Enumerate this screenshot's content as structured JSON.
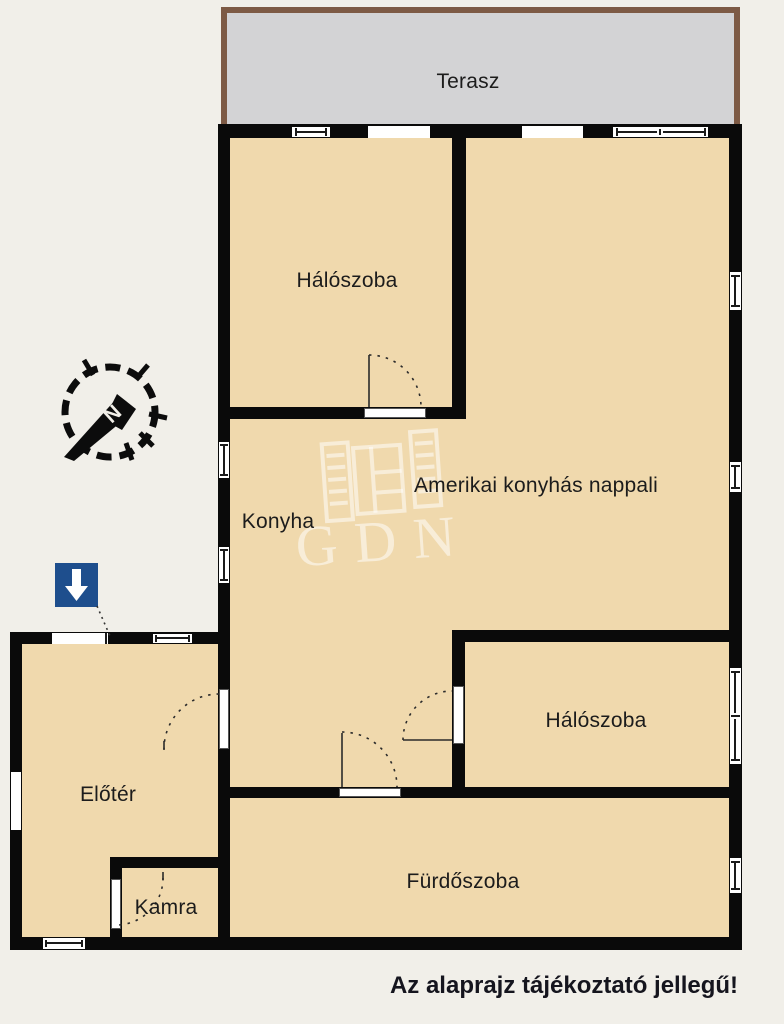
{
  "colors": {
    "bg": "#f1efe9",
    "floor": "#f0d9ad",
    "wall": "#0a0a0a",
    "terrace-fill": "#d3d3d5",
    "terrace-border": "#7d5a45",
    "arrow-blue": "#1e4e8d",
    "label": "#1c1c1c",
    "disclaimer": "#15151e",
    "watermark": "rgba(255,255,255,0.52)"
  },
  "rooms": {
    "terrace": {
      "label": "Terasz"
    },
    "bedroom_top": {
      "label": "Hálószoba"
    },
    "living": {
      "label": "Amerikai konyhás nappali"
    },
    "kitchen": {
      "label": "Konyha"
    },
    "bedroom_right": {
      "label": "Hálószoba"
    },
    "foyer": {
      "label": "Előtér"
    },
    "pantry": {
      "label": "Kamra"
    },
    "bathroom": {
      "label": "Fürdőszoba"
    }
  },
  "annotations": {
    "disclaimer": "Az alaprajz tájékoztató jellegű!",
    "compass_letter": "N",
    "watermark_text": "GDN"
  },
  "icons": {
    "compass": "compass-rose-icon",
    "entrance_marker": "blue-down-arrow-icon",
    "watermark_logo": "window-shutters-logo-icon"
  }
}
